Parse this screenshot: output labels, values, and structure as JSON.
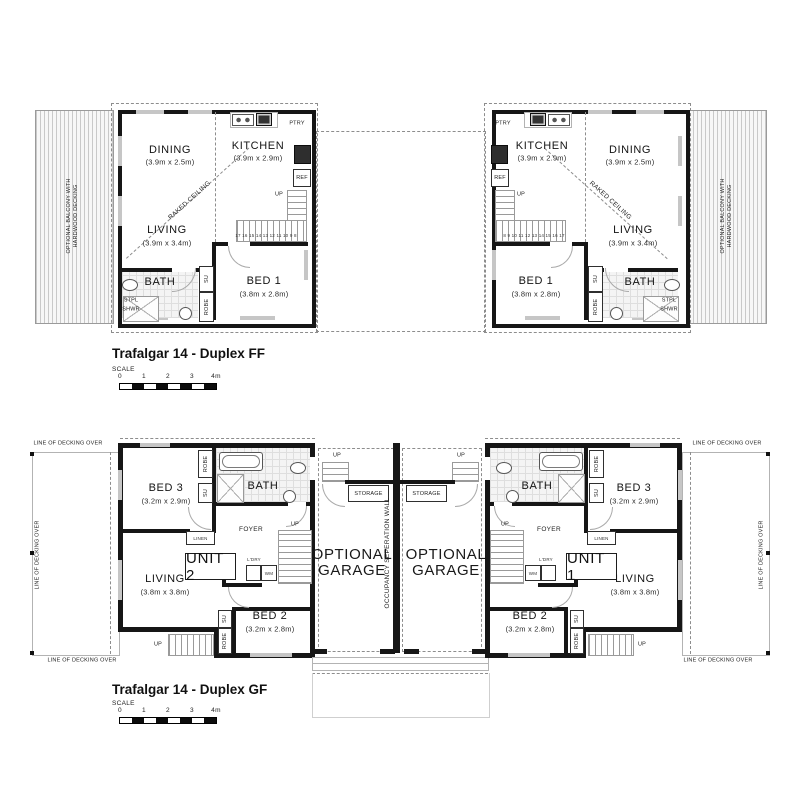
{
  "ff": {
    "title": "Trafalgar 14 - Duplex FF",
    "balcony_line1": "OPTIONAL BALCONY WITH",
    "balcony_line2": "HARDWOOD DECKING",
    "dining": "DINING",
    "dining_dim": "(3.9m x 2.5m)",
    "kitchen": "KITCHEN",
    "kitchen_dim": "(3.9m x 2.9m)",
    "living": "LIVING",
    "living_dim": "(3.9m x 3.4m)",
    "bed1": "BED 1",
    "bed1_dim": "(3.8m x 2.8m)",
    "bath": "BATH",
    "stpl": "STPL",
    "shwr": "SHWR",
    "su": "SU",
    "robe": "ROBE",
    "ptry": "PTRY",
    "ref": "REF",
    "raked_ceiling": "RAKED CEILING",
    "up": "UP",
    "stair_numbers_left": "17 16 15 14 13 12 11 10 9 8",
    "stair_numbers_right": "8 9 10 11 12 13 14 15 16 17"
  },
  "gf": {
    "title": "Trafalgar 14 - Duplex GF",
    "decking_over": "LINE OF DECKING OVER",
    "bed3": "BED 3",
    "bed3_dim": "(3.2m x 2.9m)",
    "bed2": "BED 2",
    "bed2_dim": "(3.2m x 2.8m)",
    "living": "LIVING",
    "living_dim": "(3.8m x 3.8m)",
    "bath": "BATH",
    "foyer": "FOYER",
    "linen": "LINEN",
    "unit2": "UNIT 2",
    "unit1": "UNIT 1",
    "ldry": "L'DRY",
    "wm": "WM",
    "su": "SU",
    "robe": "ROBE",
    "up": "UP",
    "storage": "STORAGE",
    "garage_line1": "OPTIONAL",
    "garage_line2": "GARAGE",
    "separation_wall": "OCCUPANCY SEPERATION WALL"
  },
  "scale": {
    "label": "SCALE",
    "ticks": [
      "0",
      "1",
      "2",
      "3",
      "4m"
    ]
  }
}
